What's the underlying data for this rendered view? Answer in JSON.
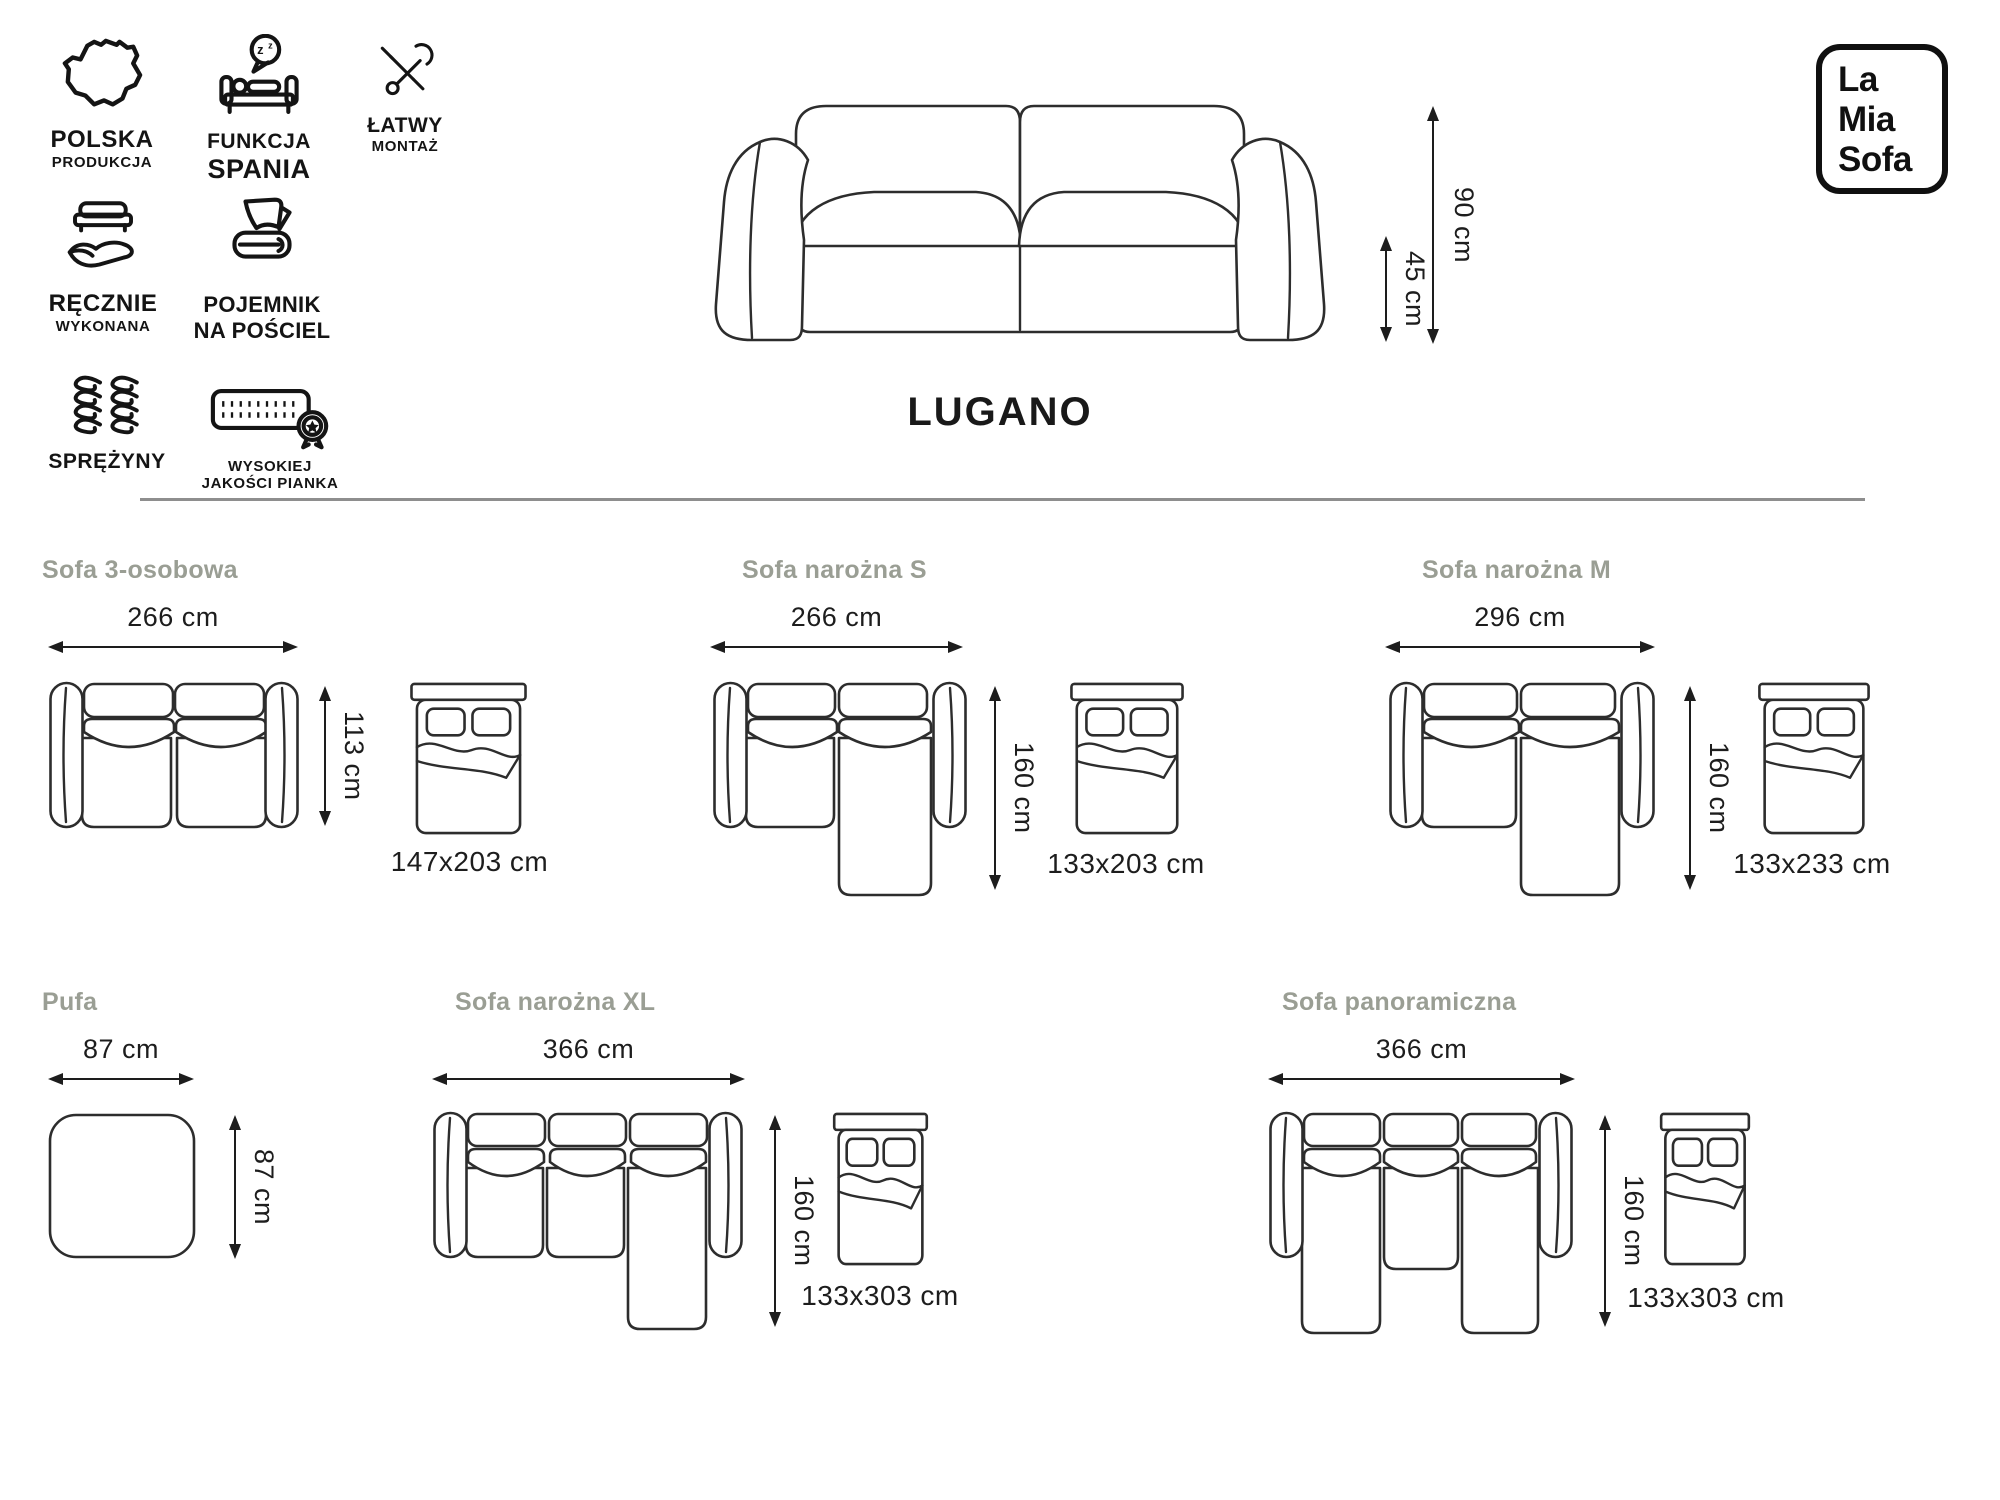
{
  "colors": {
    "background": "#ffffff",
    "heading_gray": "#9a9e94",
    "ink": "#1d1d1d",
    "line_art": "#2d2d2d"
  },
  "features": [
    {
      "icon": "poland-map-icon",
      "line1": "POLSKA",
      "line2": "PRODUKCJA"
    },
    {
      "icon": "sleep-function-icon",
      "line1": "FUNKCJA",
      "line2": "SPANIA"
    },
    {
      "icon": "tools-icon",
      "line1": "ŁATWY",
      "line2": "MONTAŻ"
    },
    {
      "icon": "handmade-icon",
      "line1": "RĘCZNIE",
      "line2": "WYKONANA"
    },
    {
      "icon": "bedding-storage-icon",
      "line1": "POJEMNIK",
      "line2": "NA POŚCIEL"
    },
    {
      "icon": "springs-icon",
      "line1": "SPRĘŻYNY",
      "line2": ""
    },
    {
      "icon": "foam-quality-icon",
      "line1": "WYSOKIEJ",
      "line2": "JAKOŚCI PIANKA"
    }
  ],
  "hero": {
    "title": "LUGANO",
    "total_height": "90 cm",
    "seat_height": "45 cm"
  },
  "logo": {
    "line1": "La",
    "line2": "Mia",
    "line3": "Sofa"
  },
  "variants": [
    {
      "name": "Sofa 3-osobowa",
      "width": "266 cm",
      "depth": "113 cm",
      "bed_size": "147x203 cm"
    },
    {
      "name": "Sofa narożna S",
      "width": "266 cm",
      "depth": "160 cm",
      "bed_size": "133x203 cm"
    },
    {
      "name": "Sofa narożna M",
      "width": "296 cm",
      "depth": "160 cm",
      "bed_size": "133x233 cm"
    },
    {
      "name": "Pufa",
      "width": "87 cm",
      "depth": "87 cm"
    },
    {
      "name": "Sofa narożna XL",
      "width": "366 cm",
      "depth": "160 cm",
      "bed_size": "133x303 cm"
    },
    {
      "name": "Sofa panoramiczna",
      "width": "366 cm",
      "depth": "160 cm",
      "bed_size": "133x303 cm"
    }
  ]
}
